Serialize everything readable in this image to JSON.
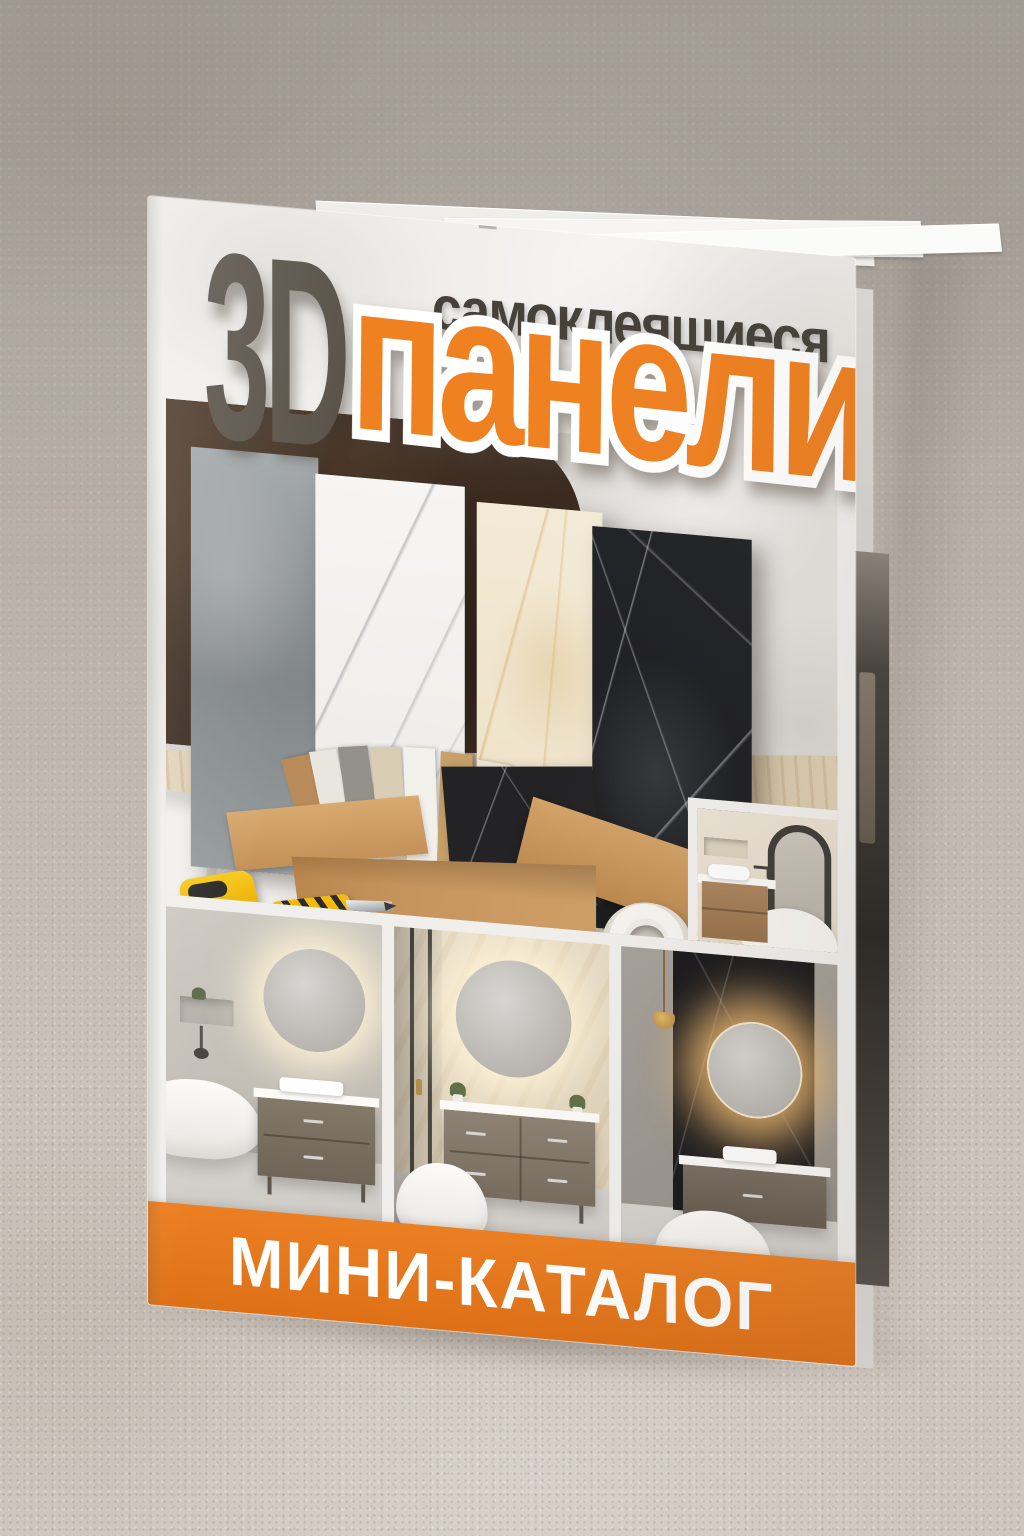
{
  "cover": {
    "title_3d": "3D",
    "subtitle": "самоклеящиеся",
    "title_main": "панели",
    "band_label": "МИНИ-КАТАЛОГ"
  },
  "colors": {
    "accent_orange": "#e8761f",
    "title_orange": "#ef8121",
    "title_dark": "#5b544b",
    "subtitle_dark": "#46413a",
    "band_text": "#ffffff",
    "brown_wall": "#46352a",
    "cardboard": "#c6955e",
    "cover_paper": "#f1efec",
    "carpet": "#beb6ae"
  }
}
